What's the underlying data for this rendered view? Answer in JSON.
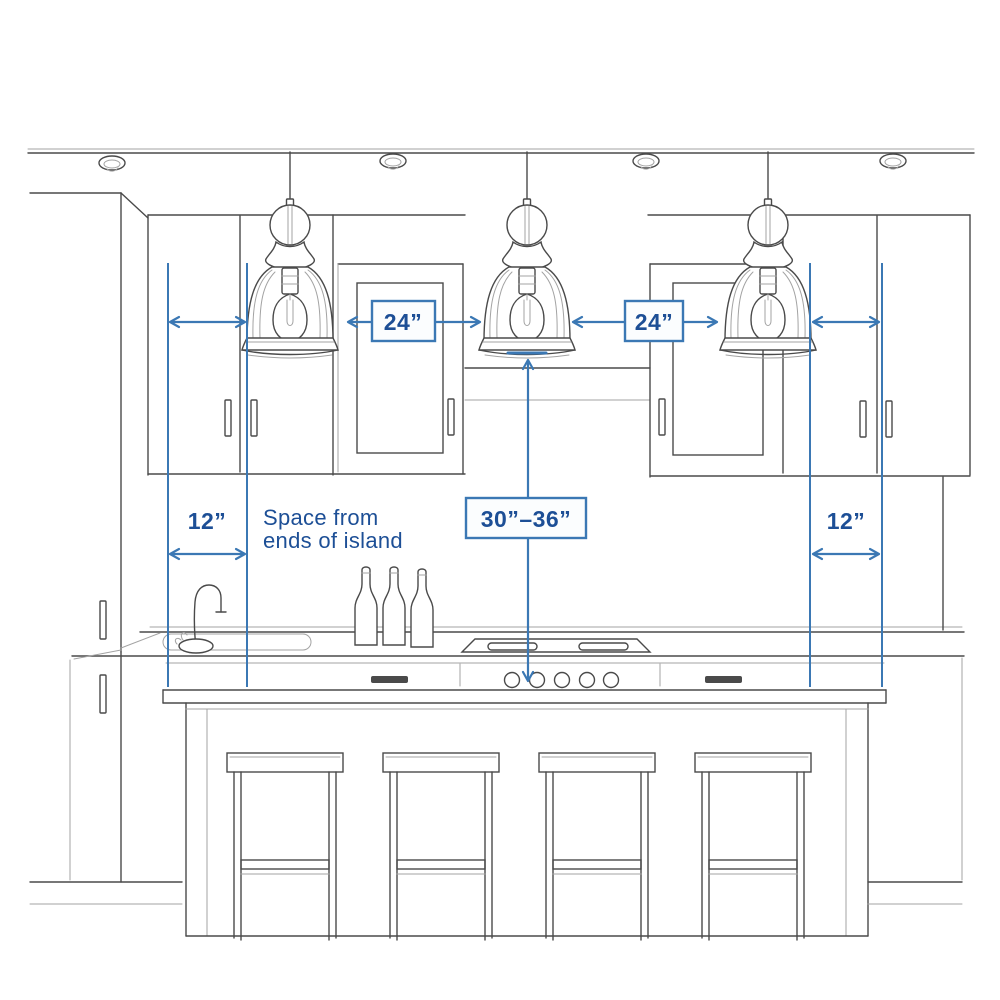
{
  "colors": {
    "background": "#ffffff",
    "sketch": "#4a4a4a",
    "sketch_light": "#a3a3a3",
    "blue": "#3b78b4",
    "navy": "#1d4f96",
    "box_bg": "#fbfdfe"
  },
  "diagram": {
    "labels": {
      "pendant_spacing_left": "24”",
      "pendant_spacing_right": "24”",
      "island_end_offset_left": "12”",
      "island_end_offset_right": "12”",
      "height_above_counter": "30”–36”",
      "note_line1": "Space from",
      "note_line2": "ends of island"
    },
    "scene": {
      "pendant_count": 3,
      "recessed_light_count": 4,
      "stool_count": 4,
      "bottle_count": 3,
      "cooktop_knob_count": 5
    }
  }
}
